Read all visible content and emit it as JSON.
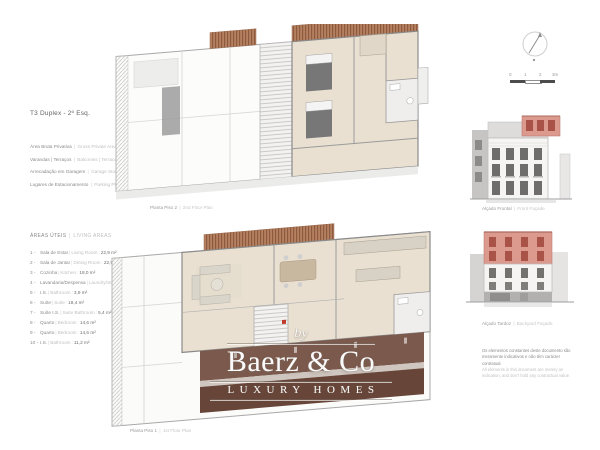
{
  "seps": {
    "bar": "|",
    "colon": ":"
  },
  "left_panel": {
    "title": "T3 Duplex - 2º Esq.",
    "summary": [
      {
        "label_pt": "Área Bruta Privativa",
        "label_en": "Gross Private Area",
        "value": "188,8 m²"
      },
      {
        "label_pt": "Varandas | Terraços",
        "label_en": "Balconies | Terraces",
        "value": "3,9 m²"
      },
      {
        "label_pt": "Arrecadação em Garagem",
        "label_en": "Garage Storage",
        "value": "24,0 m²"
      },
      {
        "label_pt": "Lugares de Estacionamento",
        "label_en": "Parking Places",
        "value": "2"
      }
    ],
    "areas_title_pt": "ÁREAS ÚTEIS",
    "areas_title_en": "LIVING AREAS",
    "areas": [
      {
        "num": "1 -",
        "label_pt": "Sala de Estar",
        "label_en": "Living Room",
        "value": "22,9 m²"
      },
      {
        "num": "2 -",
        "label_pt": "Sala de Jantar",
        "label_en": "Dining Room",
        "value": "22,9 m²"
      },
      {
        "num": "3 -",
        "label_pt": "Cozinha",
        "label_en": "Kitchen",
        "value": "18,0 m²"
      },
      {
        "num": "4 -",
        "label_pt": "Lavandaria/Despensa",
        "label_en": "Laundry/Storage",
        "value": "3,7 m²"
      },
      {
        "num": "5 -",
        "label_pt": "I.S.",
        "label_en": "Bathroom",
        "value": "3,9 m²"
      },
      {
        "num": "6 -",
        "label_pt": "Suíte",
        "label_en": "Suite",
        "value": "18,4 m²"
      },
      {
        "num": "7 -",
        "label_pt": "Suíte I.S.",
        "label_en": "Suite Bathroom",
        "value": "5,4 m²"
      },
      {
        "num": "8 -",
        "label_pt": "Quarto",
        "label_en": "Bedroom",
        "value": "14,6 m²"
      },
      {
        "num": "9 -",
        "label_pt": "Quarto",
        "label_en": "Bedroom",
        "value": "14,6 m²"
      },
      {
        "num": "10 -",
        "label_pt": "I.S.",
        "label_en": "Bathroom",
        "value": "11,2 m²"
      }
    ]
  },
  "plans": {
    "piso2": {
      "caption_pt": "Planta Piso 2",
      "caption_en": "2nd Floor Plan"
    },
    "piso1": {
      "caption_pt": "Planta Piso 1",
      "caption_en": "1st Floor Plan"
    }
  },
  "right_panel": {
    "scale_labels": [
      "0",
      "1",
      "2",
      "3m"
    ],
    "elevations": {
      "front": {
        "caption_pt": "Alçado Frontal",
        "caption_en": "Front Façade"
      },
      "rear": {
        "caption_pt": "Alçado Tardoz",
        "caption_en": "Backyard Façade"
      }
    },
    "disclaimer_pt": "Os elementos constantes deste documento são meramente indicativos e não têm carácter contratual.",
    "disclaimer_en": "All elements in this document are merely an indication, and don't hold any contractual value."
  },
  "watermark": {
    "prefix": "by",
    "name": "Baerz & Co",
    "tagline": "LUXURY HOMES"
  },
  "colors": {
    "unit_highlight": "#dc9a8e",
    "highlight_windows": "#a85248",
    "deck_wood": "#a4735c",
    "shadow_band": "#7b594c"
  }
}
